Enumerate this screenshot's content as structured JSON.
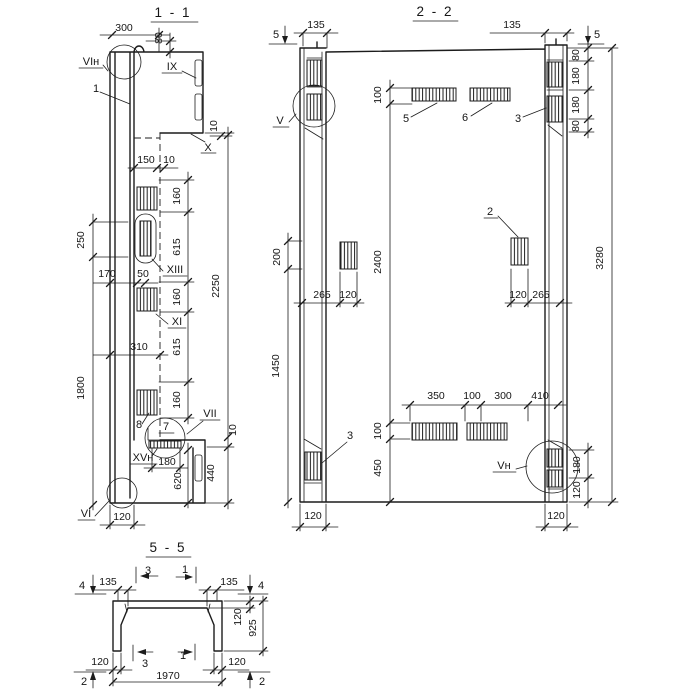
{
  "colors": {
    "ink": "#1c1c1c",
    "paper": "#ffffff"
  },
  "s11": {
    "title": "1 - 1",
    "dims": {
      "d300": "300",
      "d80": "80",
      "d10a": "10",
      "d150": "150",
      "d10b": "10",
      "d160a": "160",
      "d615a": "615",
      "d160b": "160",
      "d615b": "615",
      "d160c": "160",
      "d2250": "2250",
      "d250": "250",
      "d170": "170",
      "d50": "50",
      "d1800": "1800",
      "d310": "310",
      "d10c": "10",
      "d440": "440",
      "d620": "620",
      "d180": "180",
      "d120": "120"
    },
    "marks": {
      "vi_n": "VIн",
      "pos1": "1",
      "ix": "IX",
      "x": "X",
      "xiii": "XIII",
      "xi": "XI",
      "pos8": "8",
      "pos7": "7",
      "vii": "VII",
      "xv_n": "XVн",
      "vi": "VI"
    }
  },
  "s22": {
    "title": "2 - 2",
    "dims": {
      "d135l": "135",
      "d135r": "135",
      "d80a": "80",
      "d180a": "180",
      "d180b": "180",
      "d80b": "80",
      "d3280": "3280",
      "d100t": "100",
      "d2400": "2400",
      "d100b": "100",
      "d450": "450",
      "d200": "200",
      "d1450": "1450",
      "d265l": "265",
      "d120l": "120",
      "d120r": "120",
      "d265r": "265",
      "d350": "350",
      "d100m": "100",
      "d300": "300",
      "d410": "410",
      "d180rb": "180",
      "d120rb": "120",
      "d120bl": "120",
      "d120br": "120"
    },
    "marks": {
      "cut5l": "5",
      "cut5r": "5",
      "v": "V",
      "v_n": "Vн",
      "pos5": "5",
      "pos6": "6",
      "pos3r": "3",
      "pos3l": "3",
      "pos2": "2"
    }
  },
  "s55": {
    "title": "5 - 5",
    "dims": {
      "d135l": "135",
      "d135r": "135",
      "d120f": "120",
      "d925": "925",
      "d120bl": "120",
      "d120br": "120",
      "d1970": "1970"
    },
    "marks": {
      "cut4l": "4",
      "cut4r": "4",
      "cut3t": "3",
      "cut1t": "1",
      "cut3b": "3",
      "cut1b": "1",
      "cut2l": "2",
      "cut2r": "2"
    }
  }
}
